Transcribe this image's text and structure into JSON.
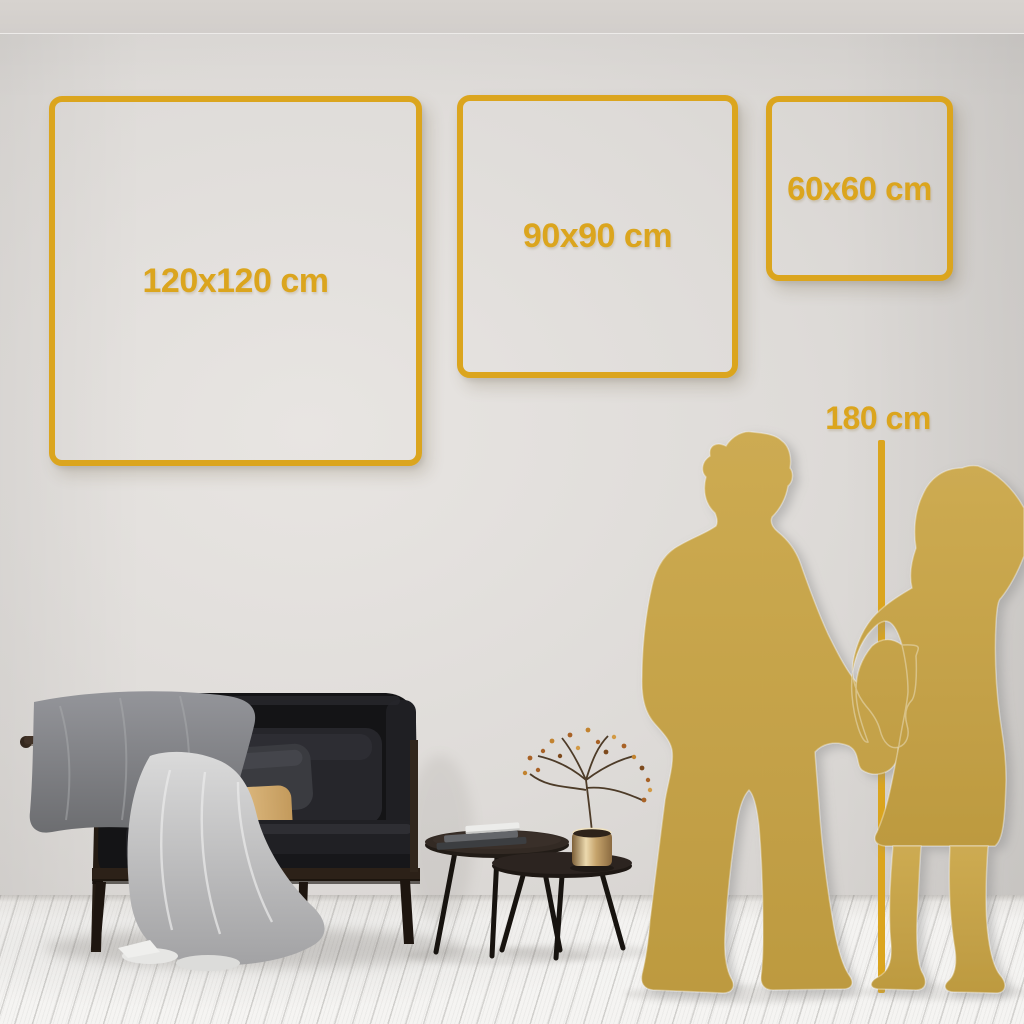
{
  "size_guide": {
    "frames": [
      {
        "label": "120x120 cm",
        "width_cm": 120,
        "height_cm": 120
      },
      {
        "label": "90x90 cm",
        "width_cm": 90,
        "height_cm": 90
      },
      {
        "label": "60x60 cm",
        "width_cm": 60,
        "height_cm": 60
      }
    ],
    "reference_height": {
      "label": "180 cm",
      "value_cm": 180
    }
  },
  "scene_objects": [
    "couple-silhouette",
    "height-ruler-line",
    "sofa",
    "throw-blankets",
    "pillows",
    "nesting-coffee-tables",
    "books",
    "brass-vase-with-dried-branches"
  ],
  "colors": {
    "accent_gold": "#DBA51E",
    "silhouette_gold": "#C7A54B",
    "wall": "#DCD9D6",
    "floor": "#F4F3F1"
  }
}
